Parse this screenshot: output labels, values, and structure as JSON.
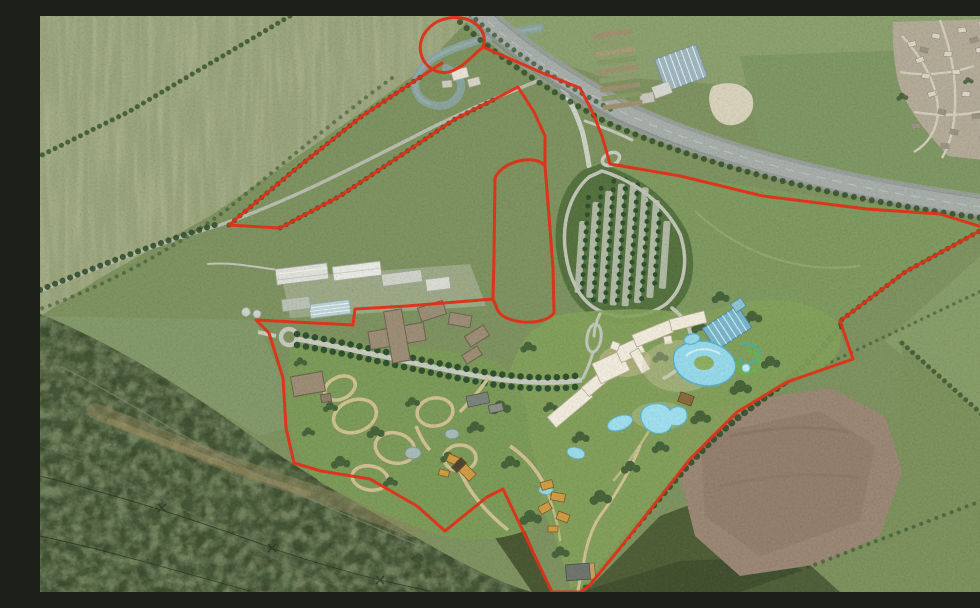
{
  "map": {
    "description": "Aerial photograph masterplan of a proposed leisure resort with a red site boundary line overlaid",
    "boundary": {
      "name": "site-boundary",
      "color": "#e03018",
      "style": "solid-line"
    },
    "features": [
      {
        "id": "motorway-corridor",
        "label": "motorway corridor"
      },
      {
        "id": "river-oxbow",
        "label": "river oxbow meander"
      },
      {
        "id": "northwest-field-strip",
        "label": "north-west boundary field strip"
      },
      {
        "id": "village",
        "label": "village"
      },
      {
        "id": "farm-sheds",
        "label": "farm sheds and yard"
      },
      {
        "id": "existing-works-buildings",
        "label": "existing works buildings"
      },
      {
        "id": "allotments",
        "label": "allotment strips"
      },
      {
        "id": "entrance-roundabout",
        "label": "entrance roundabout"
      },
      {
        "id": "tree-lined-avenue",
        "label": "tree-lined entrance avenue"
      },
      {
        "id": "visitor-car-park",
        "label": "visitor car park in woodland"
      },
      {
        "id": "hotel-buildings",
        "label": "hotel buildings"
      },
      {
        "id": "indoor-waterpark",
        "label": "indoor waterpark hall"
      },
      {
        "id": "outdoor-lagoon-pools",
        "label": "outdoor lagoon pools"
      },
      {
        "id": "water-slides",
        "label": "water slides"
      },
      {
        "id": "woodland-lodge-loops",
        "label": "woodland lodge path loops"
      },
      {
        "id": "lodges",
        "label": "holiday lodges"
      },
      {
        "id": "ponds",
        "label": "ponds"
      },
      {
        "id": "ploughed-field",
        "label": "ploughed field"
      },
      {
        "id": "woodland",
        "label": "woodland"
      },
      {
        "id": "pasture-fields",
        "label": "pasture fields"
      }
    ],
    "palette": {
      "field_light": "#9aa47b",
      "field_mid": "#84986a",
      "field_dark": "#6f8a58",
      "woodland": "#3e4c2f",
      "scrub": "#90855c",
      "ploughed": "#9a8774",
      "road": "#a7ada9",
      "minor_road": "#c8ccc0",
      "river": "#8aa39e",
      "boundary_red": "#e03018",
      "hotel_white": "#f0ebdc",
      "pool_aqua": "#9bdcec",
      "waterpark_teal": "#79b6ca",
      "lodge_orange": "#cf9c45",
      "new_roof_taupe": "#9c8d75",
      "path_tan": "#cfc193",
      "carpark_green": "#55723f"
    }
  }
}
